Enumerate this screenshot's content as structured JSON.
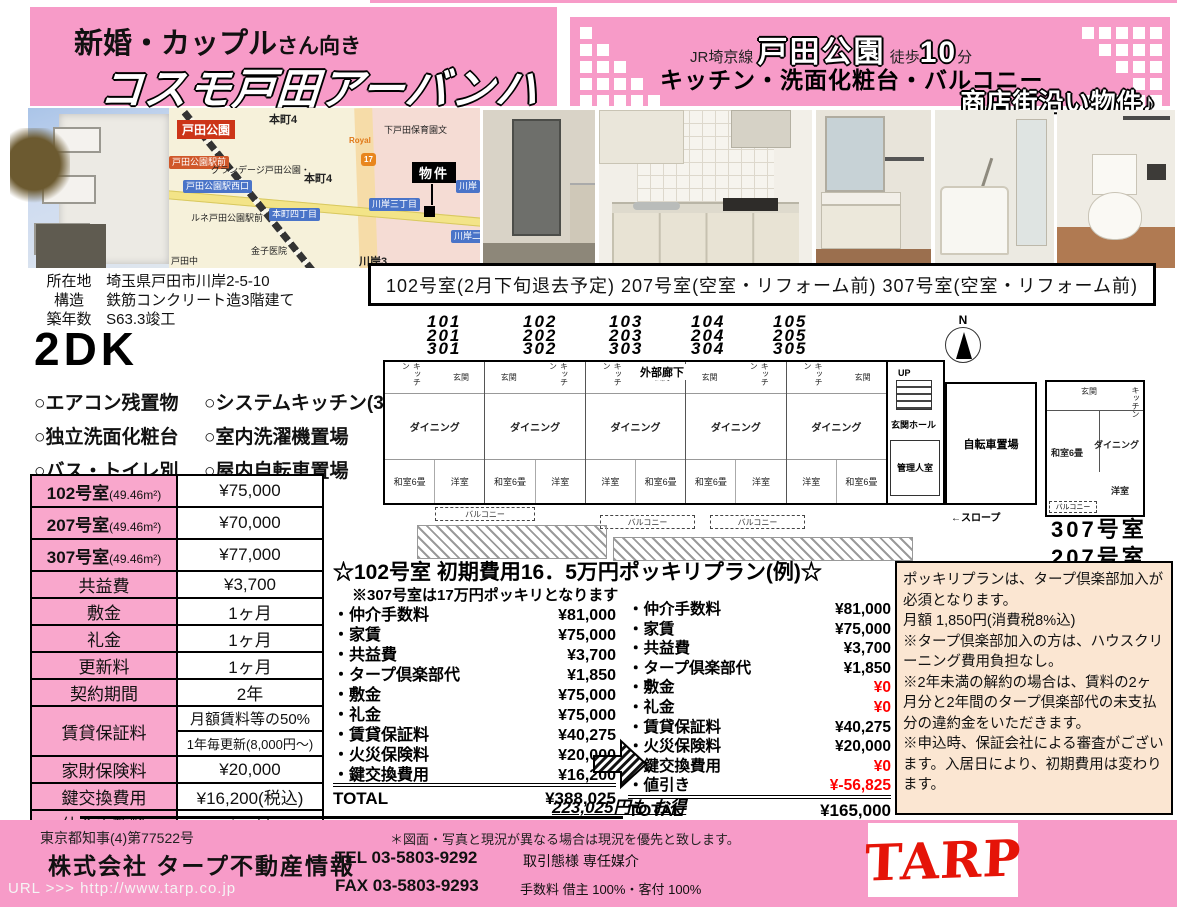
{
  "colors": {
    "pink": "#f79bc8",
    "table_pink": "#f9a7cc",
    "notice_peach": "#fbe6d2",
    "alert_red": "#ff0000",
    "logo_red": "#e51408"
  },
  "header": {
    "audience_main": "新婚・カップル",
    "audience_sub": "さん向き",
    "property_name": "コスモ戸田アーバンハイム",
    "rail_line": "JR埼京線",
    "station": "戸田公園",
    "walk_prefix": "徒歩",
    "walk_minutes": "10",
    "walk_unit": "分",
    "equip_line": "キッチン・洗面化粧台・バルコニー",
    "catchcopy": "商店街沿い物件♪"
  },
  "map": {
    "station": "戸田公園",
    "marker": "物件",
    "labels": {
      "ekimae": "戸田公園駅前",
      "nishiguchi": "戸田公園駅西口",
      "grandage": "グランデージ戸田公園・",
      "honcho4_top": "本町4",
      "honcho4": "本町4",
      "rune": "ルネ戸田公園駅前",
      "honcho4chome": "本町四丁目",
      "kawagishi3chome": "川岸三丁目",
      "kawagishi2": "川岸二",
      "kawagishi": "川岸",
      "hoikuen": "下戸田保育園文",
      "kaneko": "金子医院",
      "kawagishi3": "川岸3",
      "todanaka": "戸田中",
      "royal": "Royal",
      "route17": "17"
    }
  },
  "property_info": {
    "rows": [
      {
        "label": "所在地",
        "value": "埼玉県戸田市川岸2-5-10"
      },
      {
        "label": "構造",
        "value": "鉄筋コンクリート造3階建て"
      },
      {
        "label": "築年数",
        "value": "S63.3竣工"
      }
    ]
  },
  "status_banner": "102号室(2月下旬退去予定) 207号室(空室・リフォーム前) 307号室(空室・リフォーム前)",
  "layout_type": "2DK",
  "features": [
    "○エアコン残置物",
    "○システムキッチン(3口)",
    "○独立洗面化粧台",
    "○室内洗濯機置場",
    "○バス・トイレ別",
    "○屋内自転車置場"
  ],
  "price_table": {
    "rows": [
      {
        "label": "102号室",
        "sub": "(49.46m²)",
        "value": "¥75,000"
      },
      {
        "label": "207号室",
        "sub": "(49.46m²)",
        "value": "¥70,000"
      },
      {
        "label": "307号室",
        "sub": "(49.46m²)",
        "value": "¥77,000"
      },
      {
        "label": "共益費",
        "value": "¥3,700"
      },
      {
        "label": "敷金",
        "value": "1ヶ月"
      },
      {
        "label": "礼金",
        "value": "1ヶ月"
      },
      {
        "label": "更新料",
        "value": "1ヶ月"
      },
      {
        "label": "契約期間",
        "value": "2年"
      },
      {
        "label": "賃貸保証料",
        "value": "月額賃料等の50%",
        "value2": "1年毎更新(8,000円〜)"
      },
      {
        "label": "家財保険料",
        "value": "¥20,000"
      },
      {
        "label": "鍵交換費用",
        "value": "¥16,200(税込)"
      },
      {
        "label": "仲介手数料",
        "value": "1ヶ月"
      }
    ]
  },
  "floor_plan": {
    "room_stacks": [
      [
        "101",
        "201",
        "301"
      ],
      [
        "102",
        "202",
        "302"
      ],
      [
        "103",
        "203",
        "303"
      ],
      [
        "104",
        "204",
        "304"
      ],
      [
        "105",
        "205",
        "305"
      ]
    ],
    "corridor": "外部廊下",
    "labels": {
      "entrance": "玄関",
      "kitchen": "キッチン",
      "dining": "ダイニング",
      "washitsu": "和室6畳",
      "yoshitsu": "洋室",
      "balcony": "バルコニー",
      "hall": "玄関ホール",
      "manager": "管理人室",
      "bicycle": "自転車置場",
      "slope": "←スロープ",
      "up": "UP",
      "north": "N"
    },
    "detail_room_id_1": "307号室",
    "detail_room_id_2": "207号室"
  },
  "plan": {
    "title": "☆102号室 初期費用16．5万円ポッキリプラン(例)☆",
    "note": "※307号室は17万円ポッキリとなります",
    "before": {
      "items": [
        {
          "label": "・仲介手数料",
          "value": "¥81,000"
        },
        {
          "label": "・家賃",
          "value": "¥75,000"
        },
        {
          "label": "・共益費",
          "value": "¥3,700"
        },
        {
          "label": "・タープ倶楽部代",
          "value": "¥1,850"
        },
        {
          "label": "・敷金",
          "value": "¥75,000"
        },
        {
          "label": "・礼金",
          "value": "¥75,000"
        },
        {
          "label": "・賃貸保証料",
          "value": "¥40,275"
        },
        {
          "label": "・火災保険料",
          "value": "¥20,000"
        },
        {
          "label": "・鍵交換費用",
          "value": "¥16,200"
        }
      ],
      "total_label": "TOTAL",
      "total": "¥388,025"
    },
    "after": {
      "items": [
        {
          "label": "・仲介手数料",
          "value": "¥81,000"
        },
        {
          "label": "・家賃",
          "value": "¥75,000"
        },
        {
          "label": "・共益費",
          "value": "¥3,700"
        },
        {
          "label": "・タープ倶楽部代",
          "value": "¥1,850"
        },
        {
          "label": "・敷金",
          "value": "¥0"
        },
        {
          "label": "・礼金",
          "value": "¥0"
        },
        {
          "label": "・賃貸保証料",
          "value": "¥40,275"
        },
        {
          "label": "・火災保険料",
          "value": "¥20,000"
        },
        {
          "label": "・鍵交換費用",
          "value": "¥0"
        },
        {
          "label": "・値引き",
          "value": "¥-56,825"
        }
      ],
      "total_label": "TOTAL",
      "total": "¥165,000"
    },
    "savings": "223,025円も お得"
  },
  "notice": {
    "lines": [
      "ポッキリプランは、タープ倶楽部加入が必須となります。",
      "月額 1,850円(消費税8%込)",
      "※タープ倶楽部加入の方は、ハウスクリーニング費用負担なし。",
      "※2年未満の解約の場合は、賃料の2ヶ月分と2年間のタープ倶楽部代の未支払分の違約金をいただきます。",
      "※申込時、保証会社による審査がございます。入居日により、初期費用は変わります。"
    ]
  },
  "footer": {
    "license": "東京都知事(4)第77522号",
    "company": "株式会社 タープ不動産情報",
    "url_label": "URL >>>",
    "url": "http://www.tarp.co.jp",
    "disclaimer": "＊図面・写真と現況が異なる場合は現況を優先と致します。",
    "tel": "TEL 03-5803-9292",
    "deal_type": "取引態様 専任媒介",
    "fax": "FAX 03-5803-9293",
    "fee": "手数料 借主 100%・客付 100%",
    "logo": "TARP"
  }
}
